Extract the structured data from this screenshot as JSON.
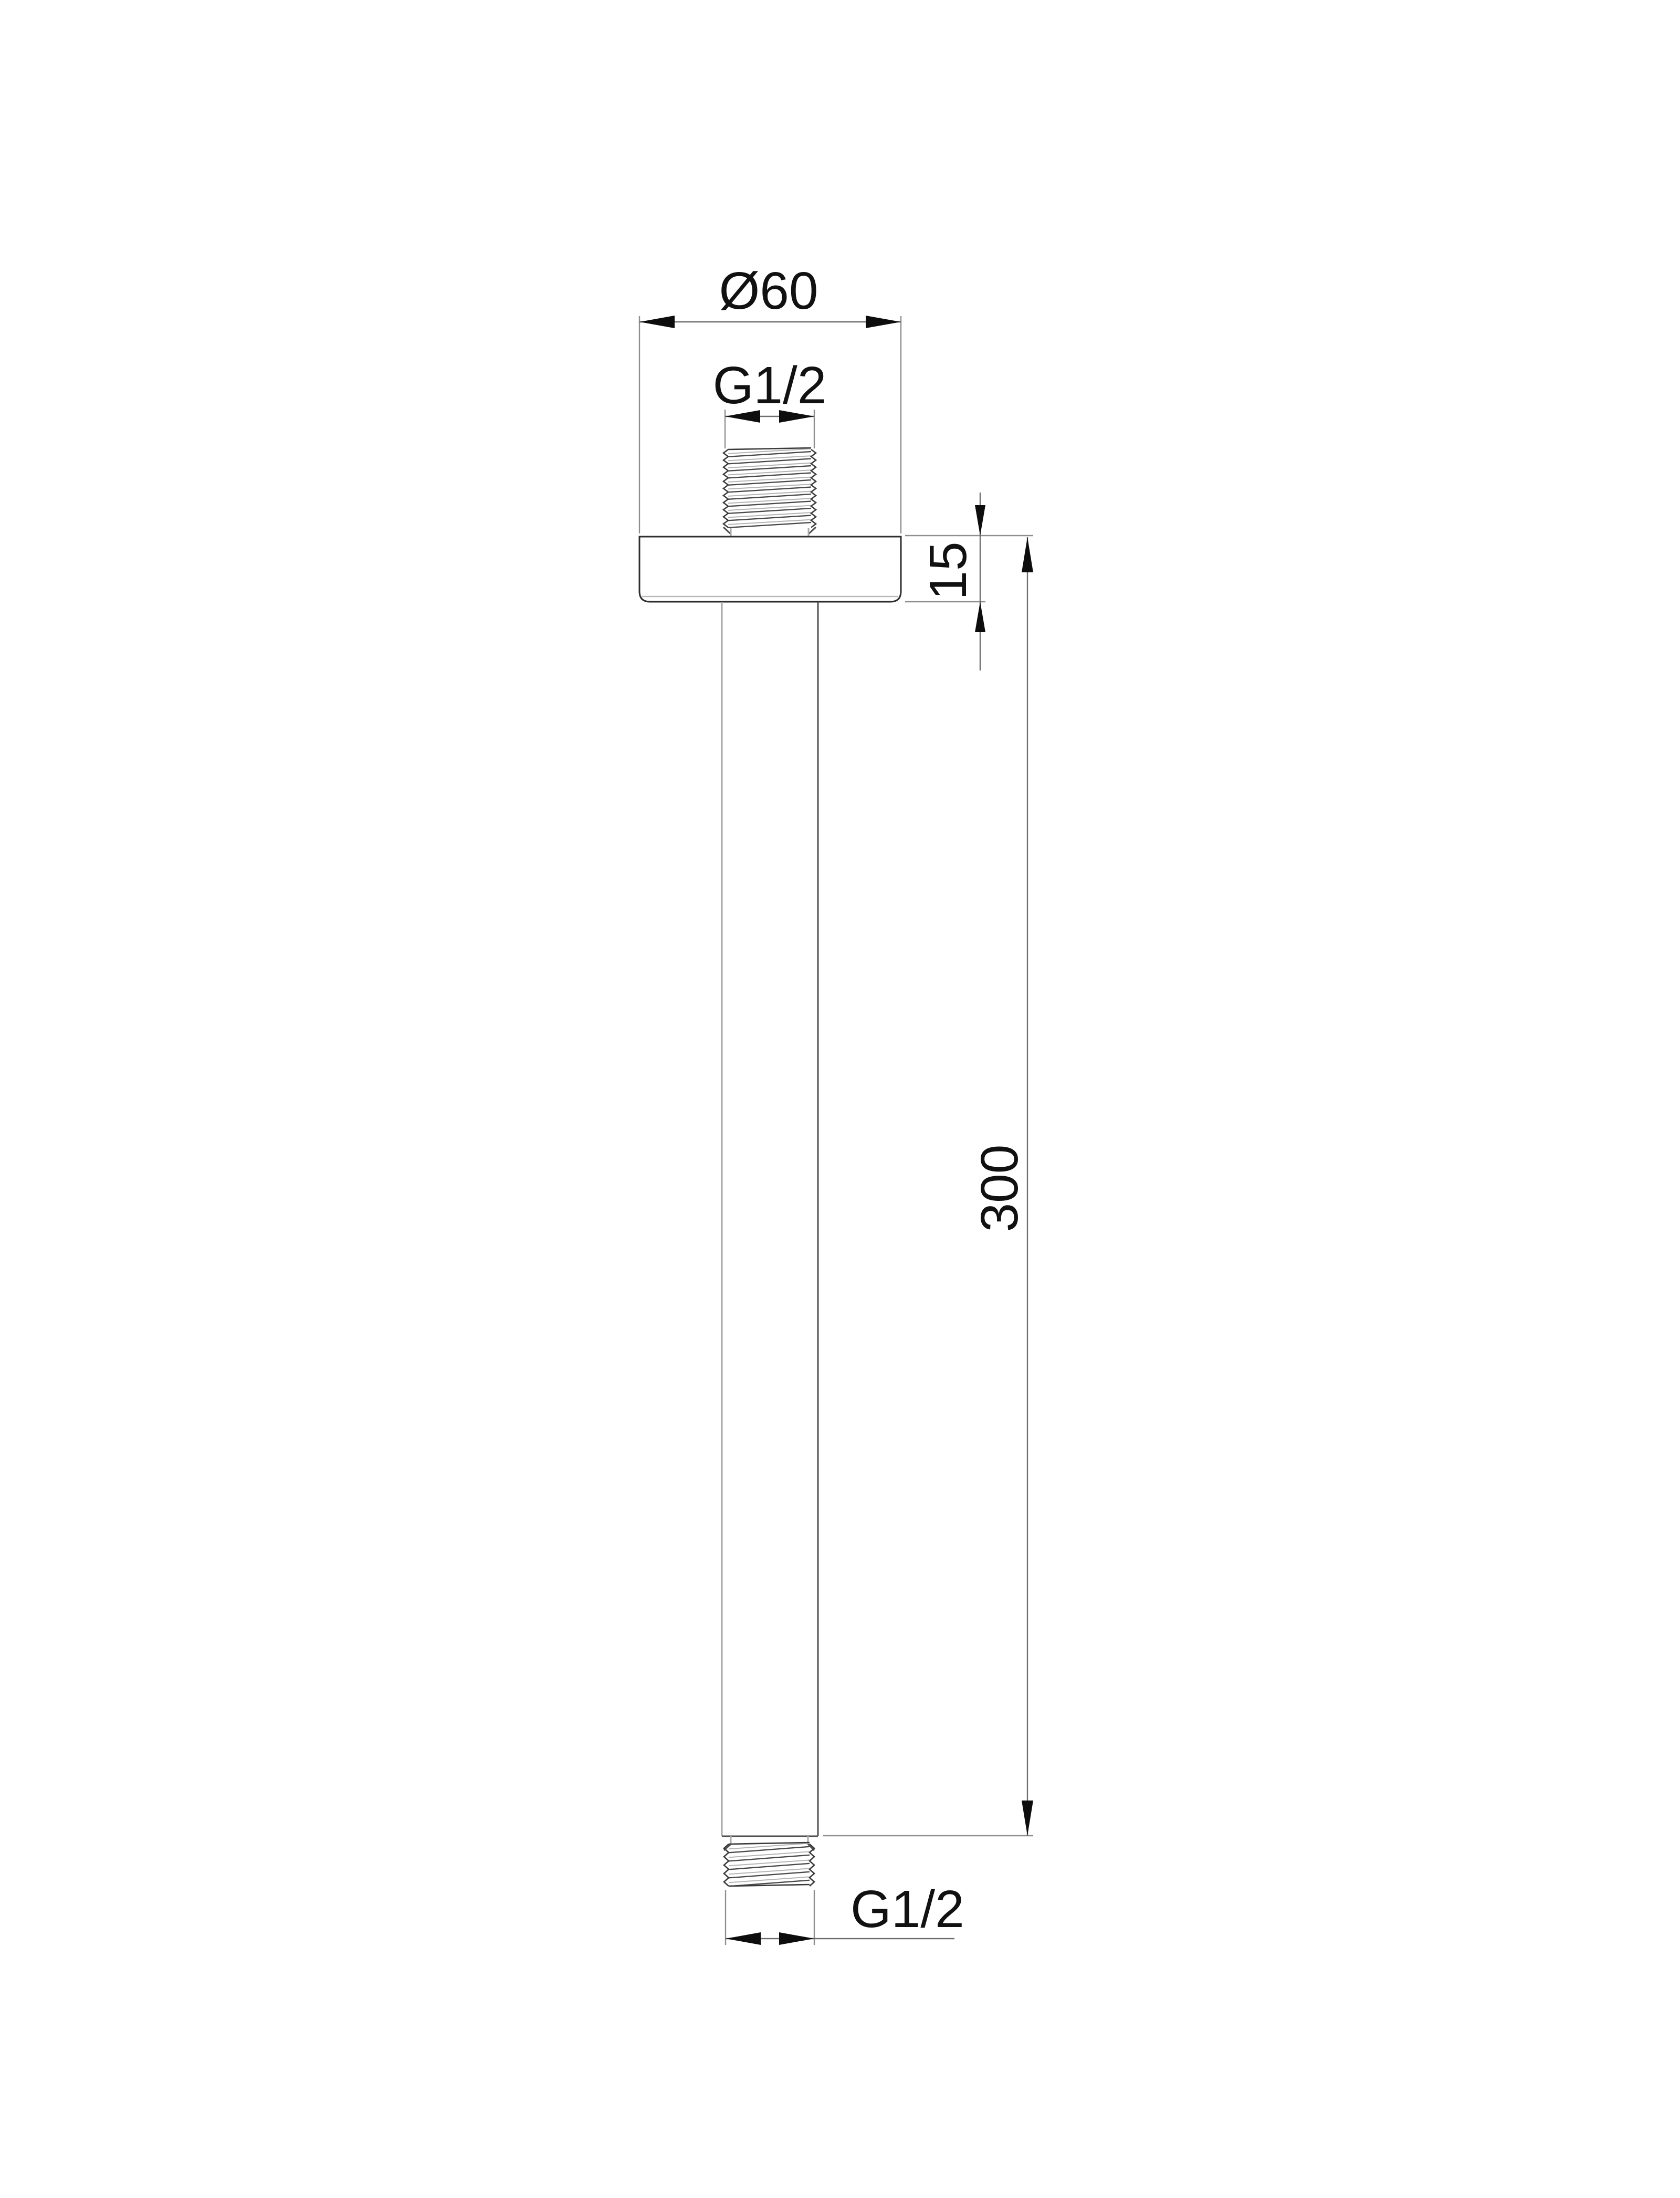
{
  "drawing": {
    "kind": "ceiling shower arm - technical line drawing",
    "labels": {
      "diameter_top": "Ø60",
      "thread_top": "G1/2",
      "plate_thickness": "15",
      "arm_length": "300",
      "thread_bottom": "G1/2"
    },
    "colors": {
      "background": "#ffffff",
      "ink": "#111111",
      "outline": "#2e2e2e",
      "dimension_lines": "#6e6e6e",
      "extension_lines": "#8f8f8f",
      "light_edges": "#a8a8a8"
    }
  }
}
